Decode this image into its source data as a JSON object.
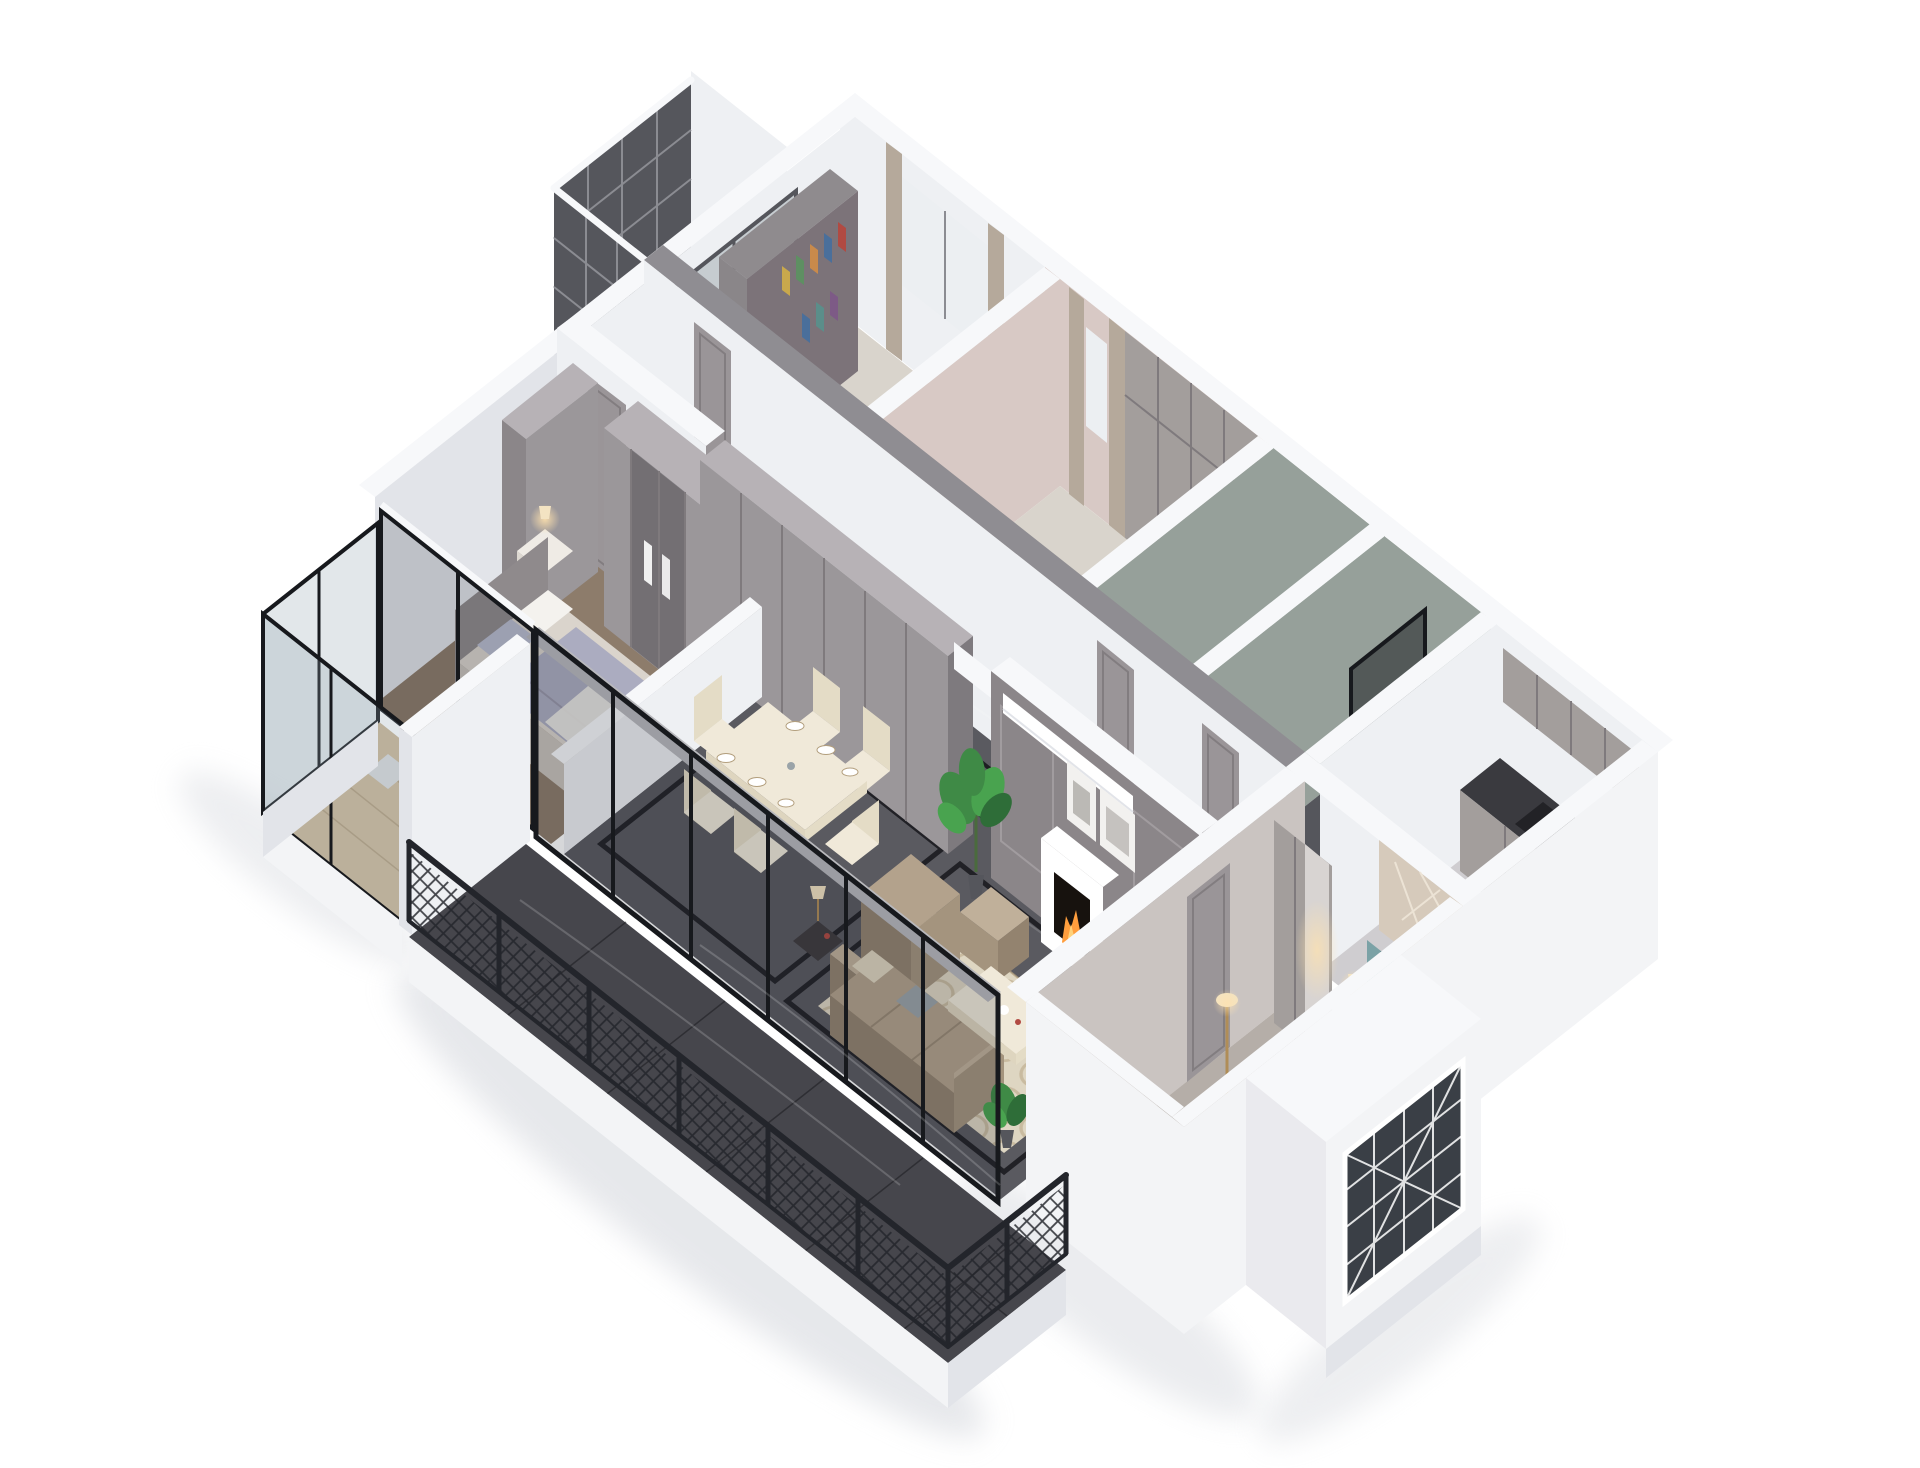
{
  "scene": {
    "label": "3D isometric cutaway rendering of an apartment floor plan on a white background",
    "style": "dollhouse architectural render, gray and white palette",
    "background": "#ffffff"
  },
  "rooms": [
    {
      "id": "study",
      "label": "Study with bookshelf, desk and curtained window"
    },
    {
      "id": "dressing-room",
      "label": "Dressing room with pink walls, wardrobes and curtain"
    },
    {
      "id": "bathroom-1",
      "label": "Bathroom with green-gray marble walls and washbasin"
    },
    {
      "id": "bathroom-2",
      "label": "Bathroom with dark glass shower partition"
    },
    {
      "id": "kitchen",
      "label": "Kitchen with gray cabinets, dark counter and cooktop"
    },
    {
      "id": "corridor",
      "label": "Corridor with gray paneled doors and marble floor"
    },
    {
      "id": "dining-area",
      "label": "Dining area with cream table and six chairs"
    },
    {
      "id": "living-room",
      "label": "Living room with fireplace, artworks, air conditioner, plant, rug and tan sofa set"
    },
    {
      "id": "bedroom-secondary",
      "label": "Secondary bedroom with lavender bedding and glass-door wardrobe"
    },
    {
      "id": "bedroom-master",
      "label": "Master bedroom with teal headboard bed, wardrobe and lamps"
    },
    {
      "id": "balcony-left",
      "label": "Small balcony with dark Chinese lattice windows"
    },
    {
      "id": "balcony-bedroom",
      "label": "Enclosed bedroom balcony with wood floor and white desk"
    },
    {
      "id": "balcony-main",
      "label": "Large balcony with dark marble floor and black lattice railing"
    },
    {
      "id": "bay-window",
      "label": "White bay window volume with decorative lattice"
    }
  ],
  "furniture": [
    "bookshelf with colored books",
    "gray hallway wardrobe cabinets",
    "fireplace with burning fire",
    "leaning framed artworks",
    "wall mounted air conditioner",
    "monstera plants in pots",
    "tan leather sofa, armchair, ottoman and coffee table",
    "cream dining table with place settings",
    "double bed with lavender blanket",
    "double bed with teal channel headboard",
    "nightstands with glowing lamps",
    "kitchen cooktop",
    "shower glass panel",
    "white desk and chair",
    "floor lamp",
    "bench"
  ],
  "palette": {
    "bg": "#ffffff",
    "wallTop": "#f7f8fa",
    "wallLight": "#eef0f3",
    "wallShade": "#e2e4e9",
    "wallExt": "#f3f4f6",
    "beam": "#8f8d92",
    "pink": "#d8c9c5",
    "green": "#96a09a",
    "panel": "#8b8689",
    "panelLight": "#9b979a",
    "panelDark": "#7e7a7e",
    "door": "#9a9598",
    "doorLine": "#827d80",
    "cab": "#a39e9c",
    "cabLight": "#b7b2b6",
    "cabLine": "#7f7a7d",
    "mirror": "#d8d4d2",
    "woodFloor": "#d9d4cc",
    "woodWarm": "#cbb696",
    "woodLine": "#a8906f",
    "marble": "#5a5a60",
    "marbleDark": "#46464c",
    "inlay": "#17181c",
    "kitchenFloor": "#cfcdd0",
    "bathFloor": "#55565c",
    "counter": "#3a3a3f",
    "cooktop": "#222226",
    "carpet": "#8d7c6b",
    "carpetMaster": "#b5aea8",
    "rug": "#ded6c2",
    "rugLine": "#b39f7e",
    "sofa": "#b3a28c",
    "sofaDark": "#93836f",
    "sofaDeep": "#a4947e",
    "sofaCap": "#c0b09a",
    "cream": "#f0e9d9",
    "creamDark": "#ded5bf",
    "creamMid": "#e4dcc6",
    "bedWhite": "#eceae4",
    "bedShadow": "#dcd9d1",
    "bedSide": "#e4e1da",
    "sheet": "#dad4cc",
    "sheetShadow": "#c9c3bb",
    "headboard2": "#8f8a8c",
    "nstand": "#efebe5",
    "nstandSide": "#ddd8d1",
    "teal": "#7ba2a6",
    "tealDark": "#5f8387",
    "lavender": "#a9aabf",
    "lavLine": "#918da0",
    "pillowBlue": "#b9bccf",
    "pillowWhite": "#f4f2ee",
    "pillowGray": "#9aa3a8",
    "foldLine": "#d4d0c8",
    "glassFrame": "#17191d",
    "glassTint": "rgba(25,35,45,0.18)",
    "glassTintLight": "rgba(140,160,170,0.25)",
    "rail": "#23252b",
    "lattice": "#55565c",
    "latticeLine": "#8b8c92",
    "curtain": "#b5a99b",
    "curtainLine": "#9c9184",
    "glassPane": "#c6ccd0",
    "windowPane": "#eceff2",
    "plant": "#3f8a46",
    "plantMid": "#49a34f",
    "plantDark": "#2e6d38",
    "stem": "#4a6b3d",
    "flame": "#ff9e3d",
    "flameIn": "#ffd27a",
    "firebox": "#17120e",
    "glowWarm": "#ffe2ae",
    "panelBeige": "#d6cabb",
    "beigeLine": "#efe6d8",
    "darkGlass": "#3a3f46",
    "shadow": "#d3d6dc",
    "artFrame": "#f2f1ef",
    "artInner": "#8e8a85",
    "white": "#ffffff",
    "moldLine": "#a19c9f",
    "shelf": "#7c7379",
    "shelfSide": "#8a8689",
    "shelfTop": "#8f8b8e",
    "bookRed": "#b14a42",
    "bookBlue": "#4a6f9b",
    "bookOrange": "#c98a4b",
    "bookGreen": "#5e8f62",
    "bookMustard": "#c9a84c",
    "bookPurple": "#7d5a86",
    "bookTeal": "#5b8e8a",
    "deskGray": "#9b9698",
    "deskSide": "#8d8890",
    "tableDark": "#3f3b3e",
    "shade": "#f3e3c2",
    "brass": "#b08d57"
  }
}
